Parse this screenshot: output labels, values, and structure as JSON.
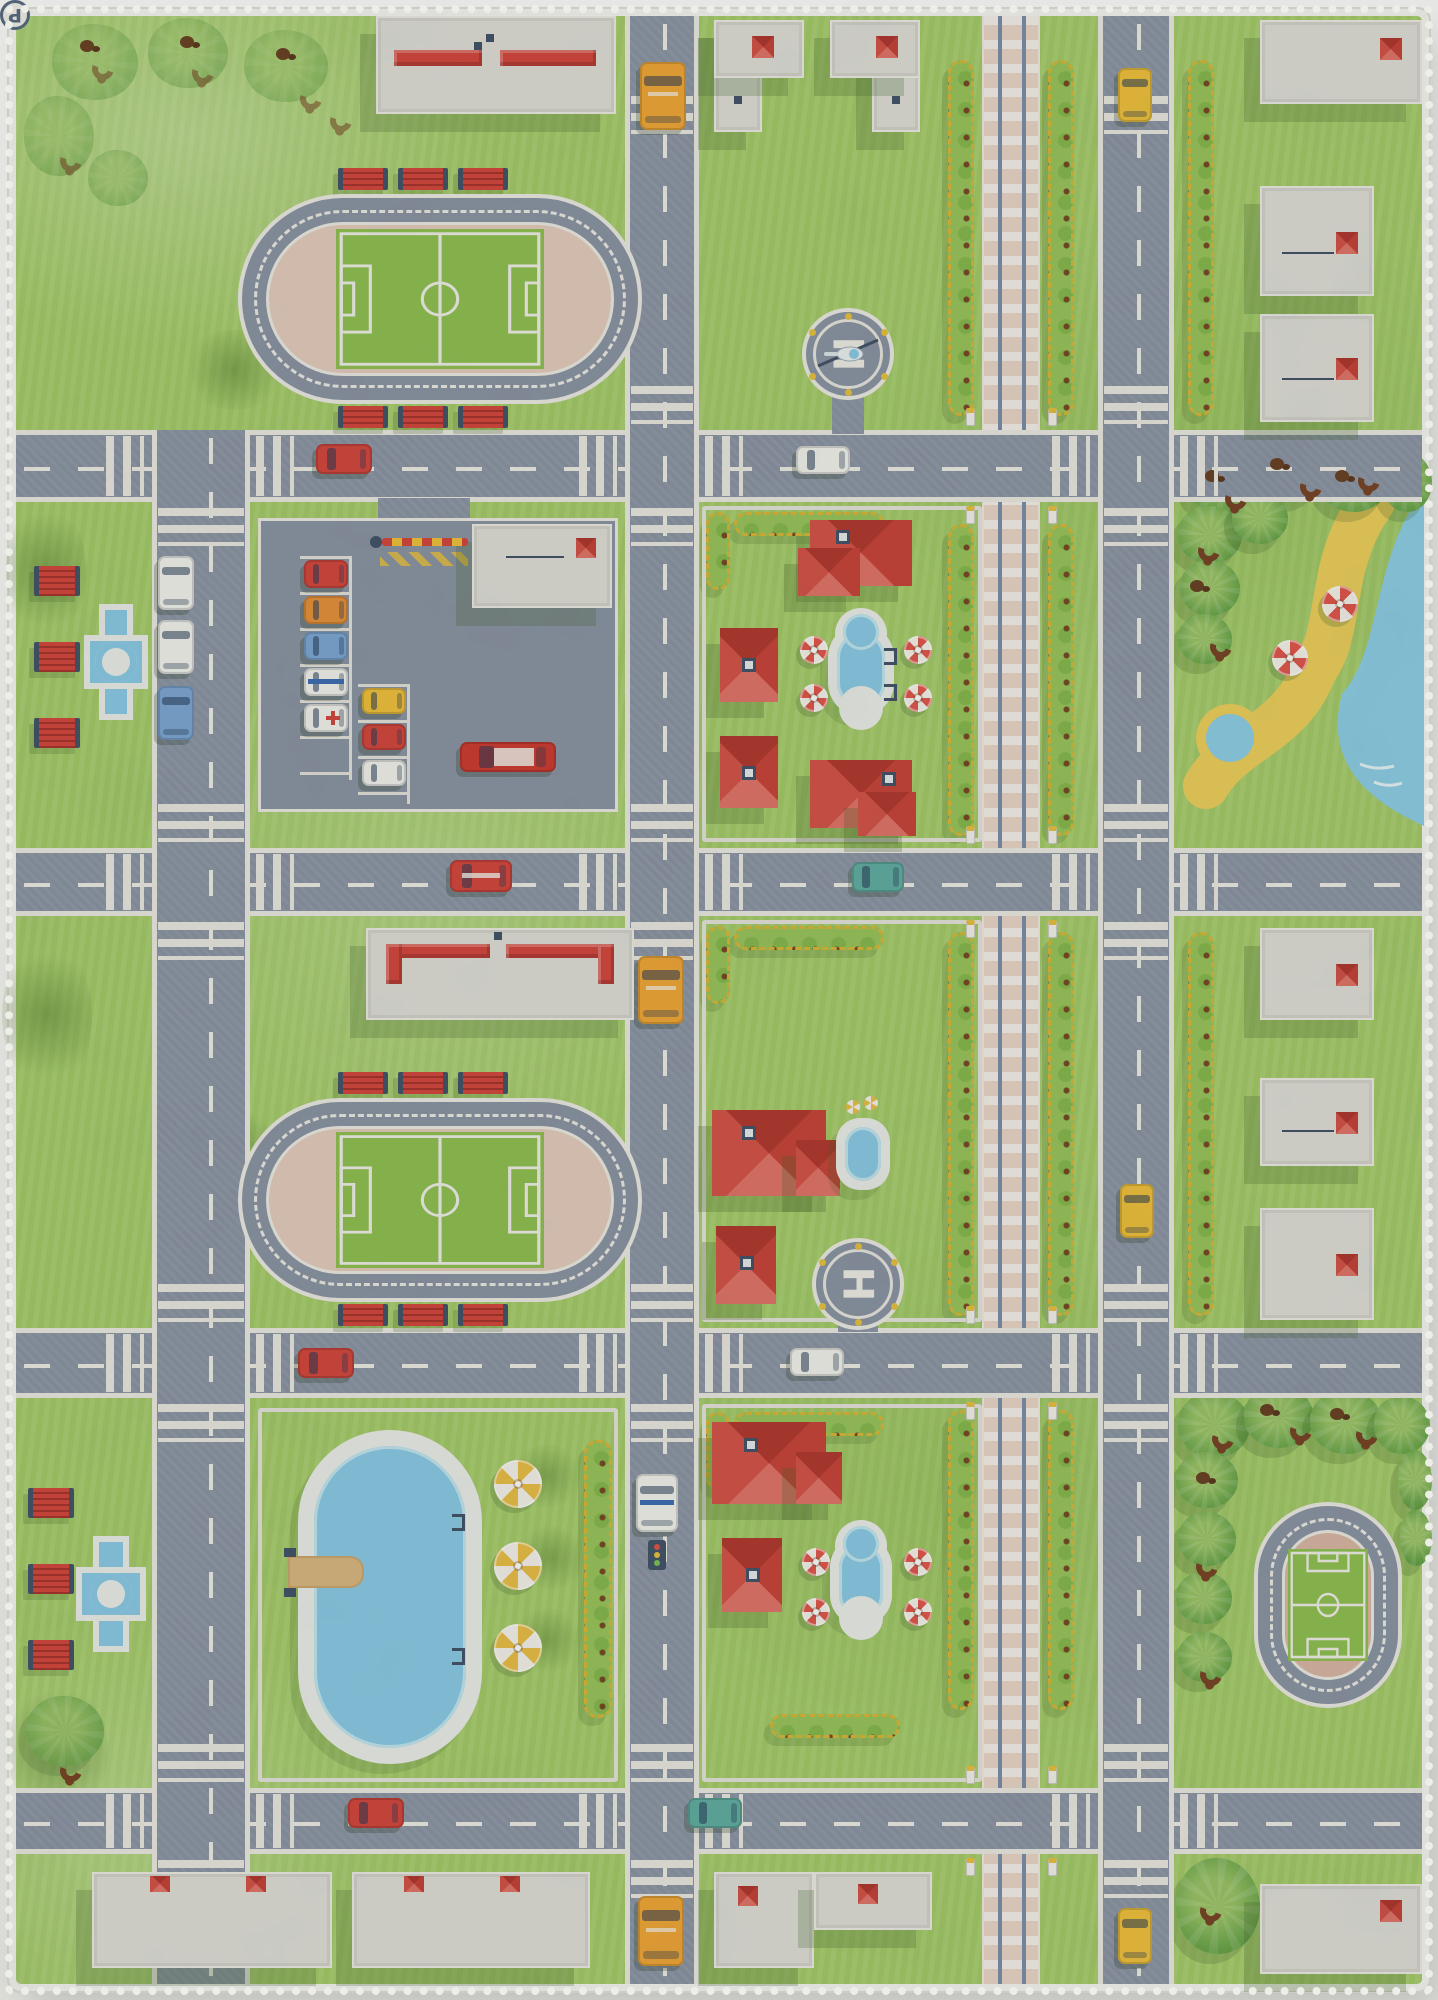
{
  "scene": {
    "subject": "Top-down children's city road play rug photographed on white background",
    "style": "watercolor printed fabric with white serged edge"
  },
  "signs": {
    "parking": "P",
    "helipad": "H"
  },
  "palette": {
    "grass": "#a9d06e",
    "road": "#8d96a7",
    "road_markings": "#f0efe9",
    "rail_bed": "#ecd9cc",
    "rail_steel": "#7d90ad",
    "roof_red": "#d6493f",
    "building_gray": "#e1e0dc",
    "water_blue": "#8ccdea",
    "sand_yellow": "#efd15e",
    "hedge_green": "#9cc75e",
    "hedge_trim_yellow": "#dcb93a",
    "track_infield_pink": "#e6cec1",
    "pitch_green": "#92c355",
    "bench_red": "#d6493f",
    "taxi_yellow": "#f2c33e",
    "bus_orange": "#f3a93a",
    "umbrella_red": "#e2584d",
    "umbrella_yellow": "#ecc04a"
  },
  "landmarks": [
    "two large oval stadium running tracks with soccer pitches and red benches",
    "mini oval soccer stadium in jungle corner",
    "parking lot with entry barrier and P sign and parked cars",
    "two helipads marked H",
    "vertical railroad line with level crossings and gate posts",
    "beach lagoon with palm trees, monkeys and red-white parasols",
    "large oval swimming pool with diving board and yellow parasols",
    "garden pools with ladders and parasols",
    "red-roofed houses with chimneys",
    "white apartment blocks with red awnings and roof chimneys",
    "park fountains with red benches",
    "yellow-trimmed hedgerows along the railroad",
    "gray roads with white curbs, dashed lanes and zebra crossings",
    "vehicles: school buses, taxis, police car, fire truck, vans, cars"
  ]
}
